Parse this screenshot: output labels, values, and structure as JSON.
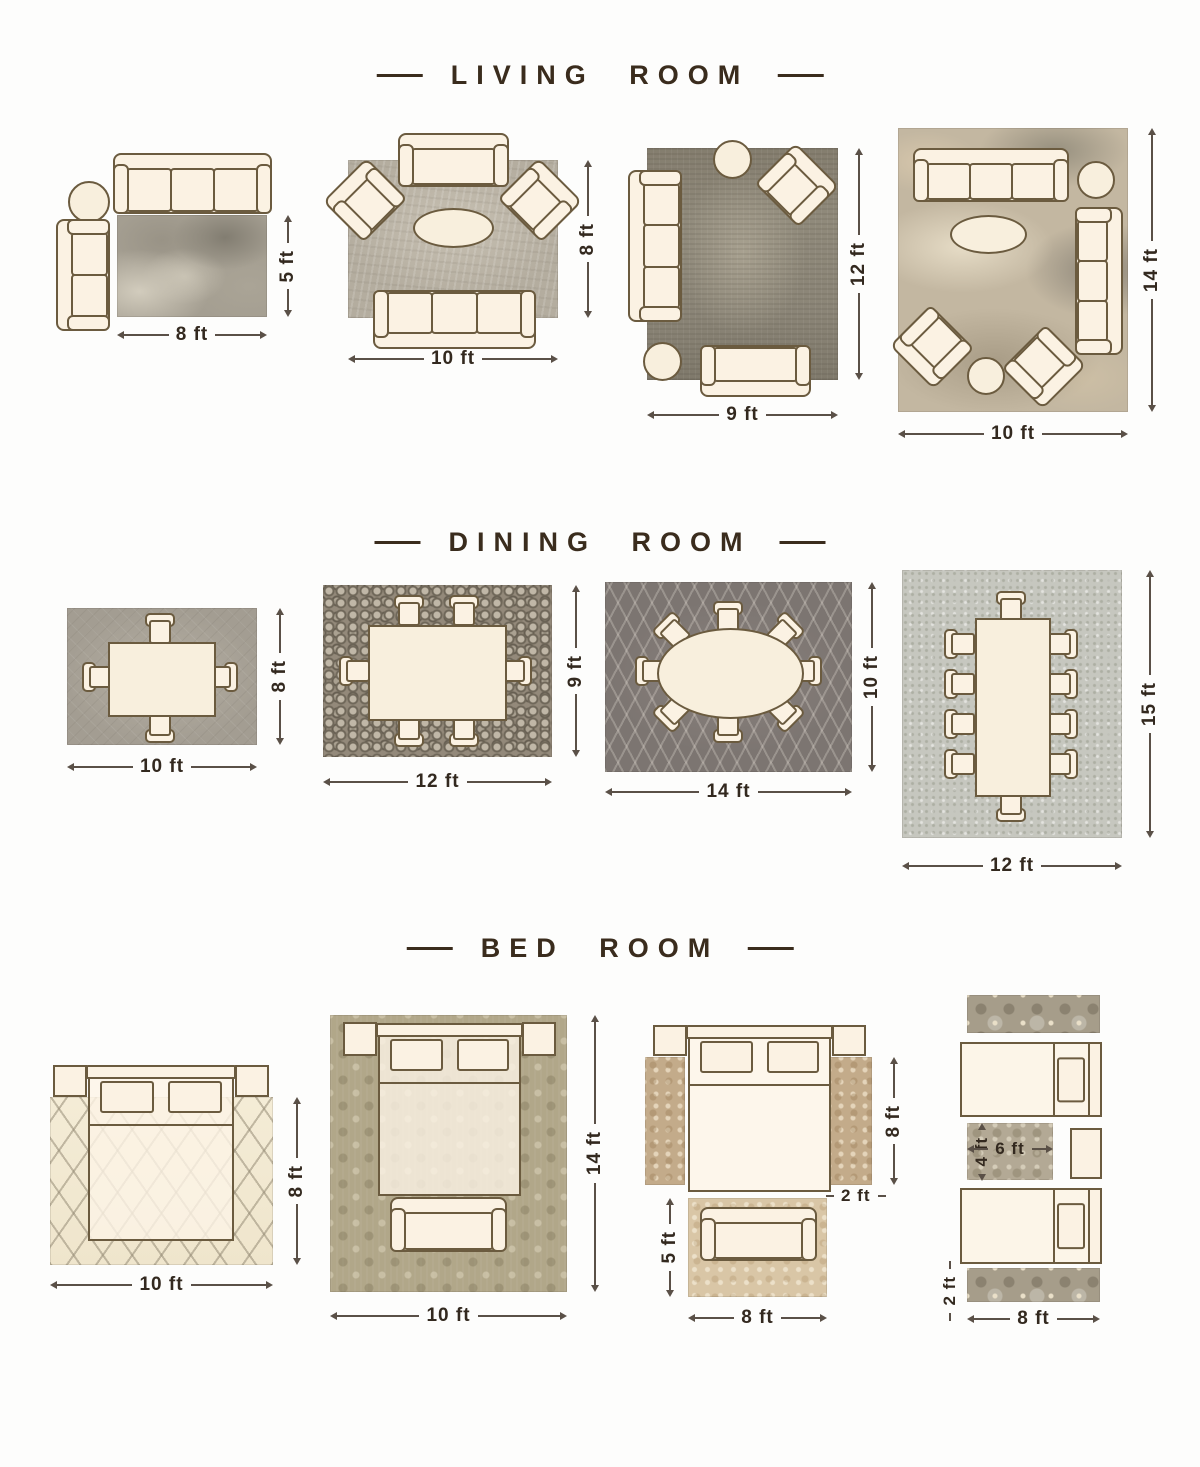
{
  "sections": [
    {
      "title": "LIVING ROOM",
      "layouts": [
        {
          "width_label": "8 ft",
          "height_label": "5 ft"
        },
        {
          "width_label": "10 ft",
          "height_label": "8 ft"
        },
        {
          "width_label": "9 ft",
          "height_label": "12 ft"
        },
        {
          "width_label": "10 ft",
          "height_label": "14 ft"
        }
      ]
    },
    {
      "title": "DINING ROOM",
      "layouts": [
        {
          "width_label": "10 ft",
          "height_label": "8 ft"
        },
        {
          "width_label": "12 ft",
          "height_label": "9 ft"
        },
        {
          "width_label": "14 ft",
          "height_label": "10 ft"
        },
        {
          "width_label": "12 ft",
          "height_label": "15 ft"
        }
      ]
    },
    {
      "title": "BED ROOM",
      "layouts": [
        {
          "width_label": "10 ft",
          "height_label": "8 ft"
        },
        {
          "width_label": "10 ft",
          "height_label": "14 ft"
        },
        {
          "width_label": "8 ft",
          "height_label": "5 ft",
          "runner_height_label": "8 ft",
          "runner_width_label": "2 ft"
        },
        {
          "width_label": "8 ft",
          "runner_height_label": "2 ft",
          "small_rug_width_label": "6 ft",
          "small_rug_height_label": "4 ft"
        }
      ]
    }
  ]
}
